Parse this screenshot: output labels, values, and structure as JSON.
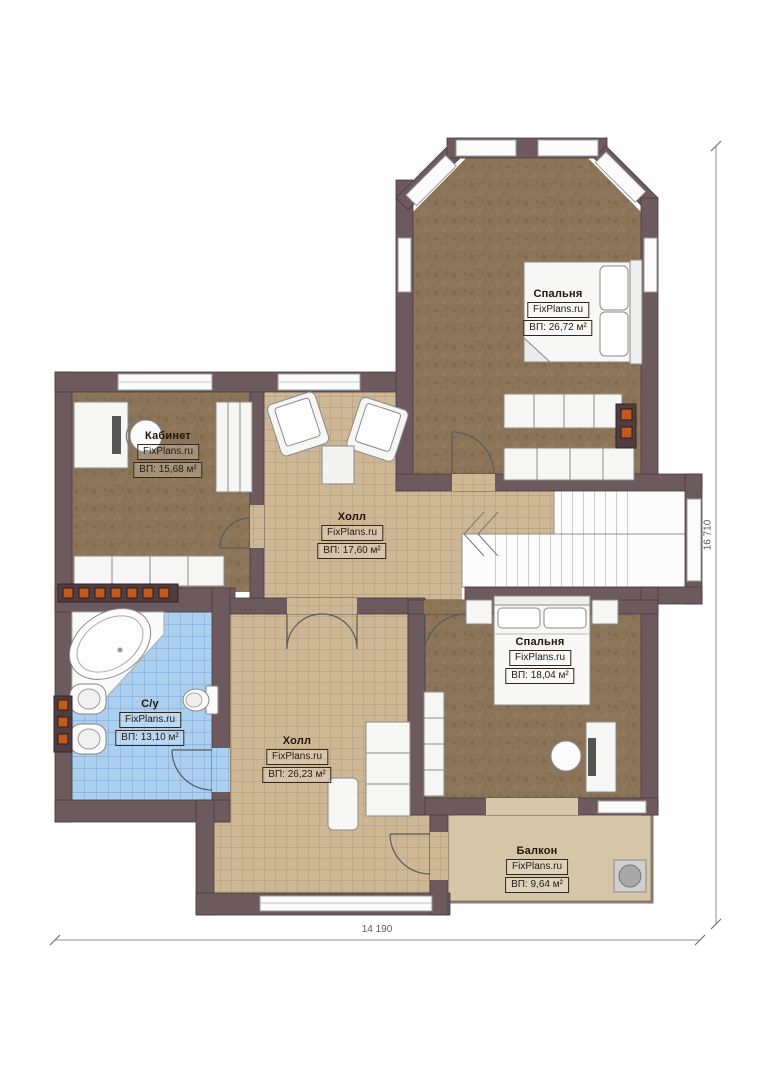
{
  "plan": {
    "rooms": [
      {
        "id": "bedroom-top",
        "name": "Спальня",
        "watermark": "FixPlans.ru",
        "area": "ВП: 26,72 м²"
      },
      {
        "id": "office",
        "name": "Кабинет",
        "watermark": "FixPlans.ru",
        "area": "ВП: 15,68 м²"
      },
      {
        "id": "hall-upper",
        "name": "Холл",
        "watermark": "FixPlans.ru",
        "area": "ВП: 17,60 м²"
      },
      {
        "id": "bathroom",
        "name": "С/у",
        "watermark": "FixPlans.ru",
        "area": "ВП: 13,10 м²"
      },
      {
        "id": "bedroom-bottom",
        "name": "Спальня",
        "watermark": "FixPlans.ru",
        "area": "ВП: 18,04 м²"
      },
      {
        "id": "hall-lower",
        "name": "Холл",
        "watermark": "FixPlans.ru",
        "area": "ВП: 26,23 м²"
      },
      {
        "id": "balcony",
        "name": "Балкон",
        "watermark": "FixPlans.ru",
        "area": "ВП: 9,64 м²"
      }
    ],
    "dimensions": {
      "bottom": "14 190",
      "right": "16 710"
    },
    "colors": {
      "wall": "#6d5a5f",
      "wall_edge": "#4c3a3f",
      "carpet": "#8b7457",
      "tile_tan": "#cdb795",
      "tile_blue": "#abcfef",
      "balcony_floor": "#d4c6a7",
      "radiator_accent": "#c05a1e",
      "window": "#fbfbfb"
    }
  }
}
